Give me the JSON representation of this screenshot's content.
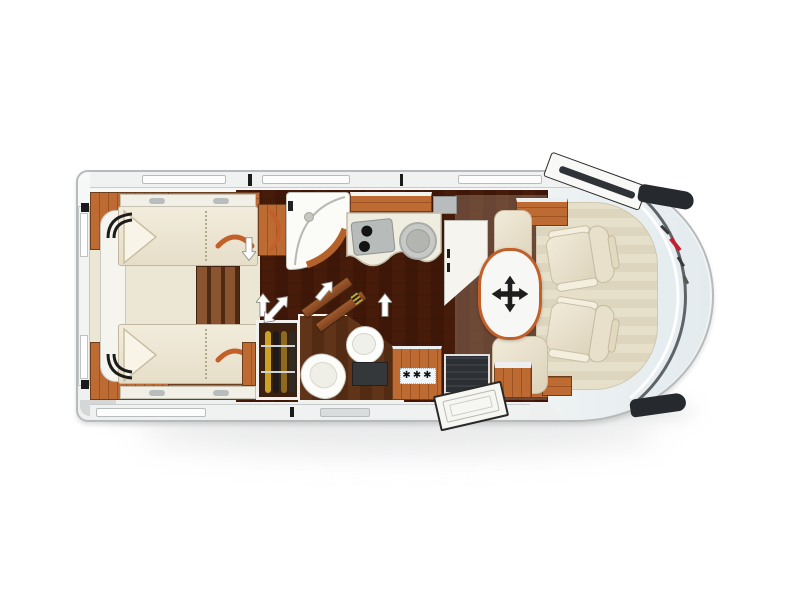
{
  "meta": {
    "title": "Motorhome floor plan — top view"
  },
  "palette": {
    "bg": "#ffffff",
    "body-stroke": "#b7babc",
    "cab-fill": "#e9eff1",
    "wood": "#b4612b",
    "wood-dark": "#8d4a1f",
    "wood-deep": "#5d3319",
    "floor": "#82502f",
    "cream": "#efe9d8",
    "accent": "#c2602a",
    "dark": "#26282c",
    "gold": "#c9a227",
    "fridge-bg": "#eef6fa",
    "fridge-border": "#8fc0dd",
    "red": "#c41e2f",
    "shadow": "#d2d4d5"
  },
  "fridge": {
    "label": "✱✱✱"
  },
  "icons": {
    "wardrobe-hanger": "orange hanger arc",
    "move-table": "black four-way arrow cross",
    "door-slide": "white outline arrow",
    "freezer-rating": "three snowflake asterisks",
    "brand-emblem": "red/black lettering on windshield"
  },
  "areas": [
    "rear-twin-single-beds",
    "center-steps",
    "foot-wardrobes",
    "clothes-wardrobe",
    "shower-cubicle",
    "kitchen-with-hob-and-sink",
    "washroom-toilet-basin",
    "fridge-freezer",
    "entry-door-with-open-flap",
    "dinette-lounge",
    "movable-table",
    "swivel-cab-seats",
    "driver-cab"
  ]
}
